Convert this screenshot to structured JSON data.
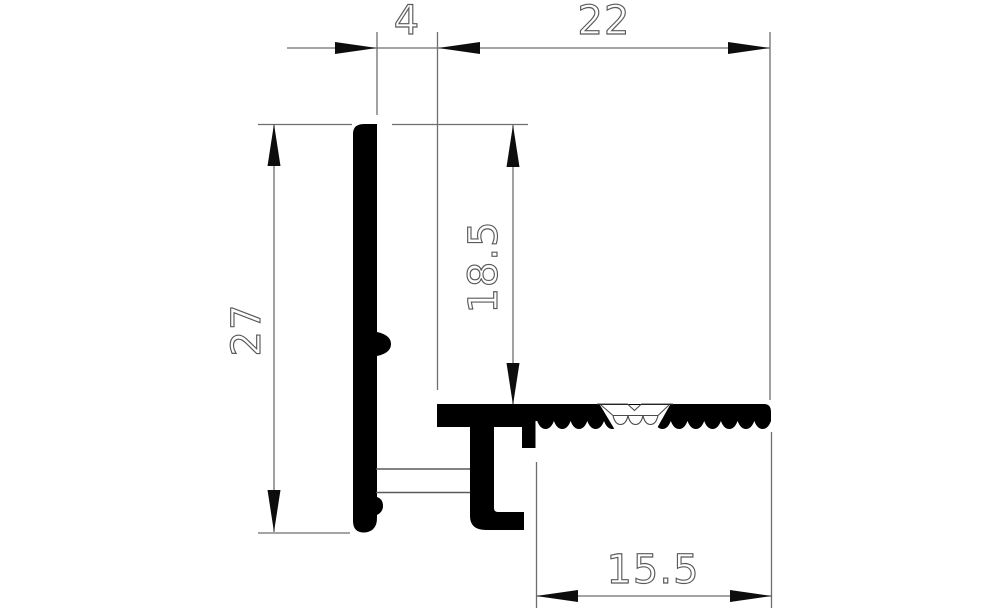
{
  "drawing": {
    "type": "technical-profile-cross-section",
    "background_color": "#ffffff",
    "profile_fill_color": "#000000",
    "dimension_line_color": "#6e6e6e",
    "dimension_text_outline_color": "#5a5a5a",
    "dimensions": {
      "slot_width": {
        "value": "4"
      },
      "base_length": {
        "value": "22"
      },
      "overall_height": {
        "value": "27"
      },
      "upstand_height": {
        "value": "18.5"
      },
      "serrated_length": {
        "value": "15.5"
      }
    }
  }
}
